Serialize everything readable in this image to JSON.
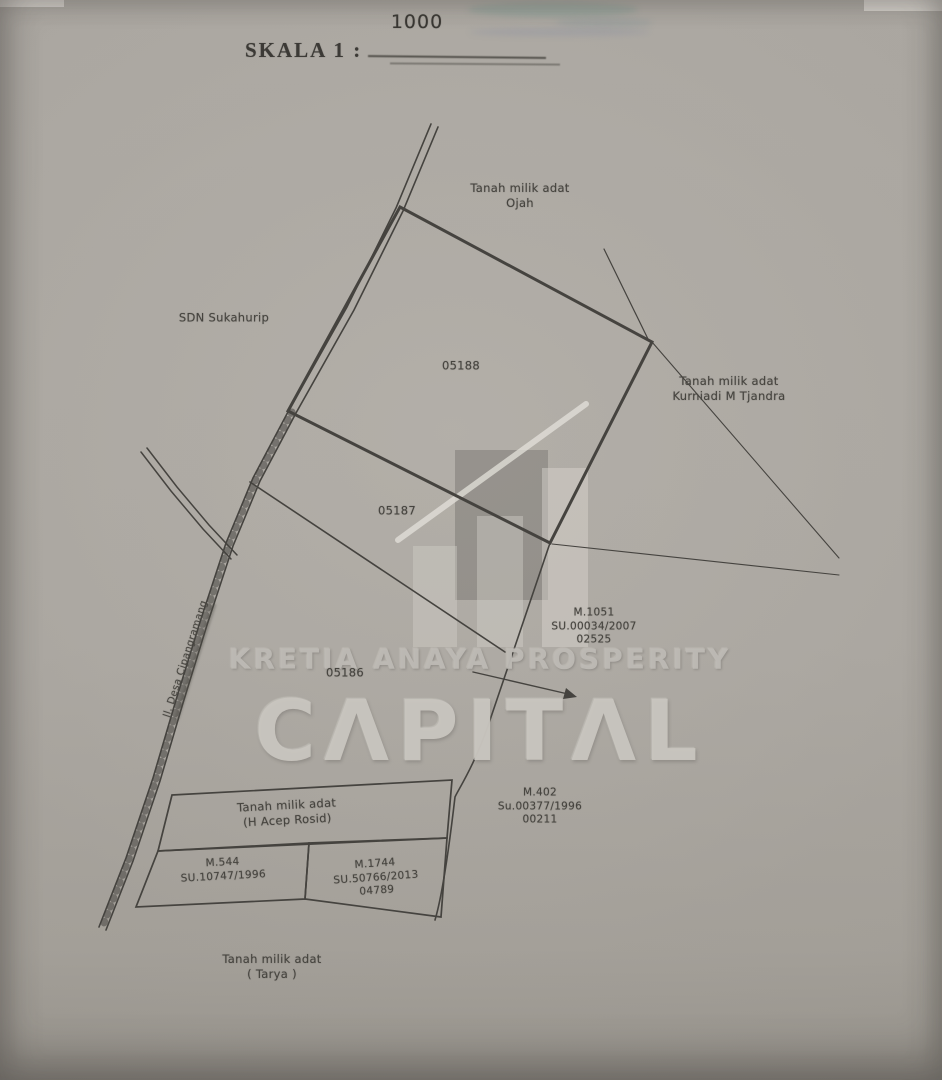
{
  "scale": {
    "label": "SKALA 1 :",
    "value": "1000"
  },
  "parcels": {
    "north": "05188",
    "middle": "05187",
    "south": "05186"
  },
  "owners": {
    "north": {
      "line1": "Tanah milik adat",
      "line2": "Ojah"
    },
    "east": {
      "line1": "Tanah milik adat",
      "line2": "Kurniadi M Tjandra"
    },
    "box": {
      "line1": "Tanah milik adat",
      "line2": "(H Acep Rosid)"
    },
    "south": {
      "line1": "Tanah milik adat",
      "line2": "( Tarya )"
    }
  },
  "landmarks": {
    "school": "SDN Sukahurip",
    "road": "Jl. Desa Cipangramang"
  },
  "certificates": {
    "m1051": {
      "line1": "M.1051",
      "line2": "SU.00034/2007",
      "line3": "02525"
    },
    "m402": {
      "line1": "M.402",
      "line2": "Su.00377/1996",
      "line3": "00211"
    },
    "m544": {
      "line1": "M.544",
      "line2": "SU.10747/1996"
    },
    "m1744": {
      "line1": "M.1744",
      "line2": "SU.50766/2013",
      "line3": "04789"
    }
  },
  "watermark": {
    "line1": "KRETIA ANAYA PROSPERITY",
    "line2": "CΛPITΛL"
  },
  "colors": {
    "paper": "#a9a59f",
    "ink": "#45433f",
    "watermark": "#bdbab4"
  }
}
